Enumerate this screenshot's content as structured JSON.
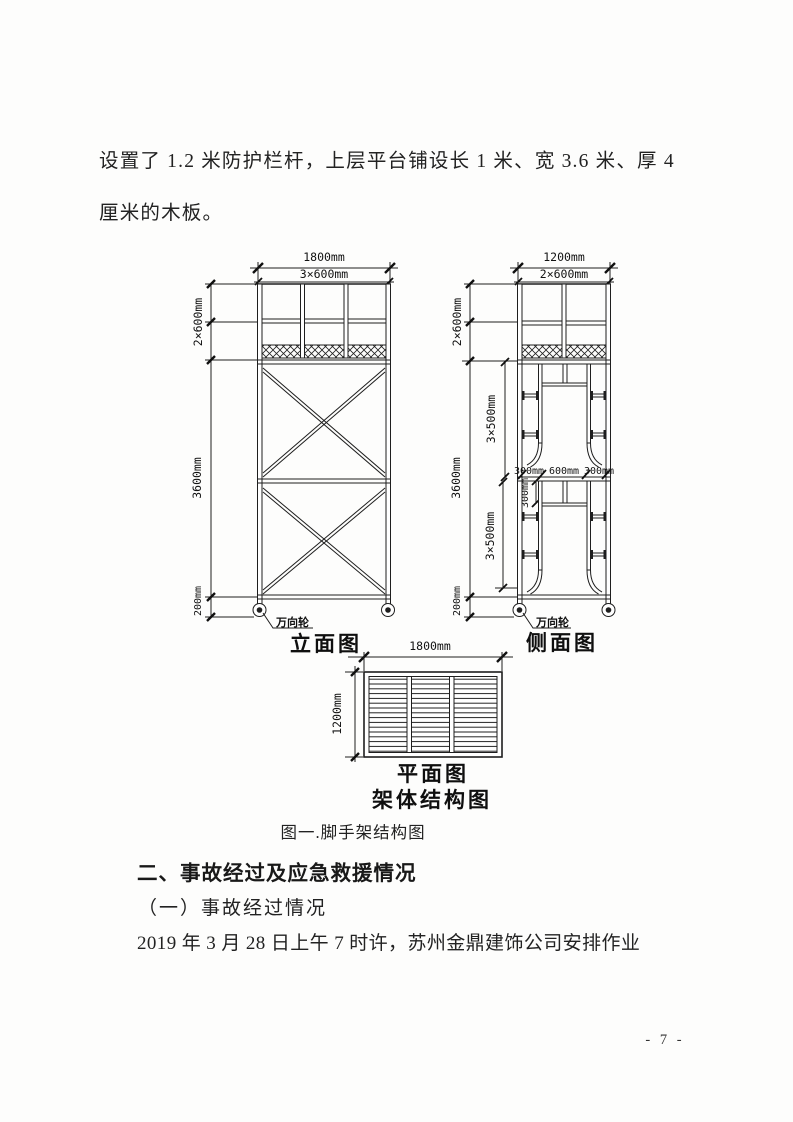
{
  "document": {
    "intro_line1": "设置了 1.2 米防护栏杆，上层平台铺设长 1 米、宽 3.6 米、厚 4",
    "intro_line2": "厘米的木板。",
    "figure_caption": "图一.脚手架结构图",
    "section_heading": "二、事故经过及应急救援情况",
    "subsection_heading": "（一）事故经过情况",
    "body_line": "2019 年 3 月 28 日上午 7 时许，苏州金鼎建饰公司安排作业",
    "page_number": "- 7 -"
  },
  "figure": {
    "front_view": {
      "label": "立面图",
      "dim_width_total": "1800mm",
      "dim_width_bays": "3×600mm",
      "dim_guard_height": "2×600mm",
      "dim_body_height": "3600mm",
      "dim_wheel_height": "200mm",
      "wheel_label": "万向轮"
    },
    "side_view": {
      "label": "侧面图",
      "dim_width_total": "1200mm",
      "dim_width_bays": "2×600mm",
      "dim_guard_height": "2×600mm",
      "dim_body_height": "3600mm",
      "dim_wheel_height": "200mm",
      "dim_rungs_upper": "3×500mm",
      "dim_rungs_lower": "3×500mm",
      "dim_mid_left": "300mm",
      "dim_mid_center": "600mm",
      "dim_mid_right": "300mm",
      "dim_step": "300mm",
      "wheel_label": "万向轮"
    },
    "plan_view": {
      "label": "平面图",
      "dim_width": "1800mm",
      "dim_depth": "1200mm"
    },
    "assembly_label": "架体结构图"
  }
}
